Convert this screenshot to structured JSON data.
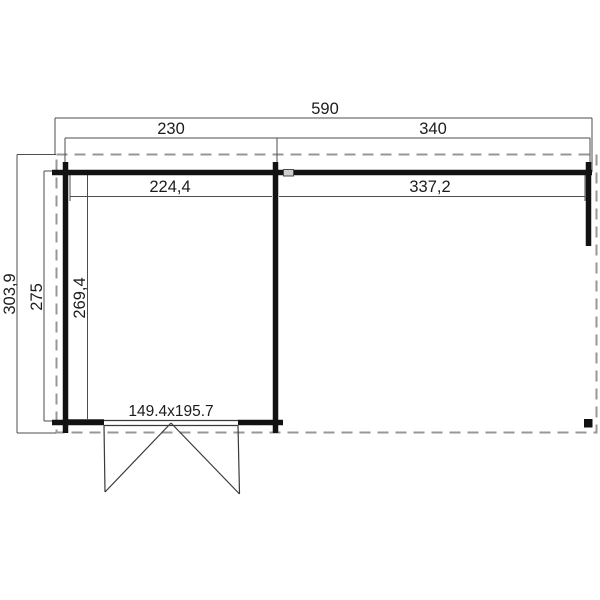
{
  "plan": {
    "kind": "cabin-floor-plan",
    "dims": {
      "overall_width": "590",
      "left_section_width": "230",
      "right_section_width": "340",
      "left_inner_width": "224,4",
      "right_inner_width": "337,2",
      "roof_depth": "303,9",
      "body_depth": "275",
      "inner_depth": "269,4",
      "door_size": "149.4x195.7"
    },
    "colors": {
      "background": "#ffffff",
      "wall": "#121212",
      "dimension_line": "#4d4d4d",
      "dashed_roof_outline": "#979797",
      "label_text": "#1c1c1c",
      "wall_connector_fill": "#cccccc",
      "corner_post_fill": "#111111"
    }
  }
}
